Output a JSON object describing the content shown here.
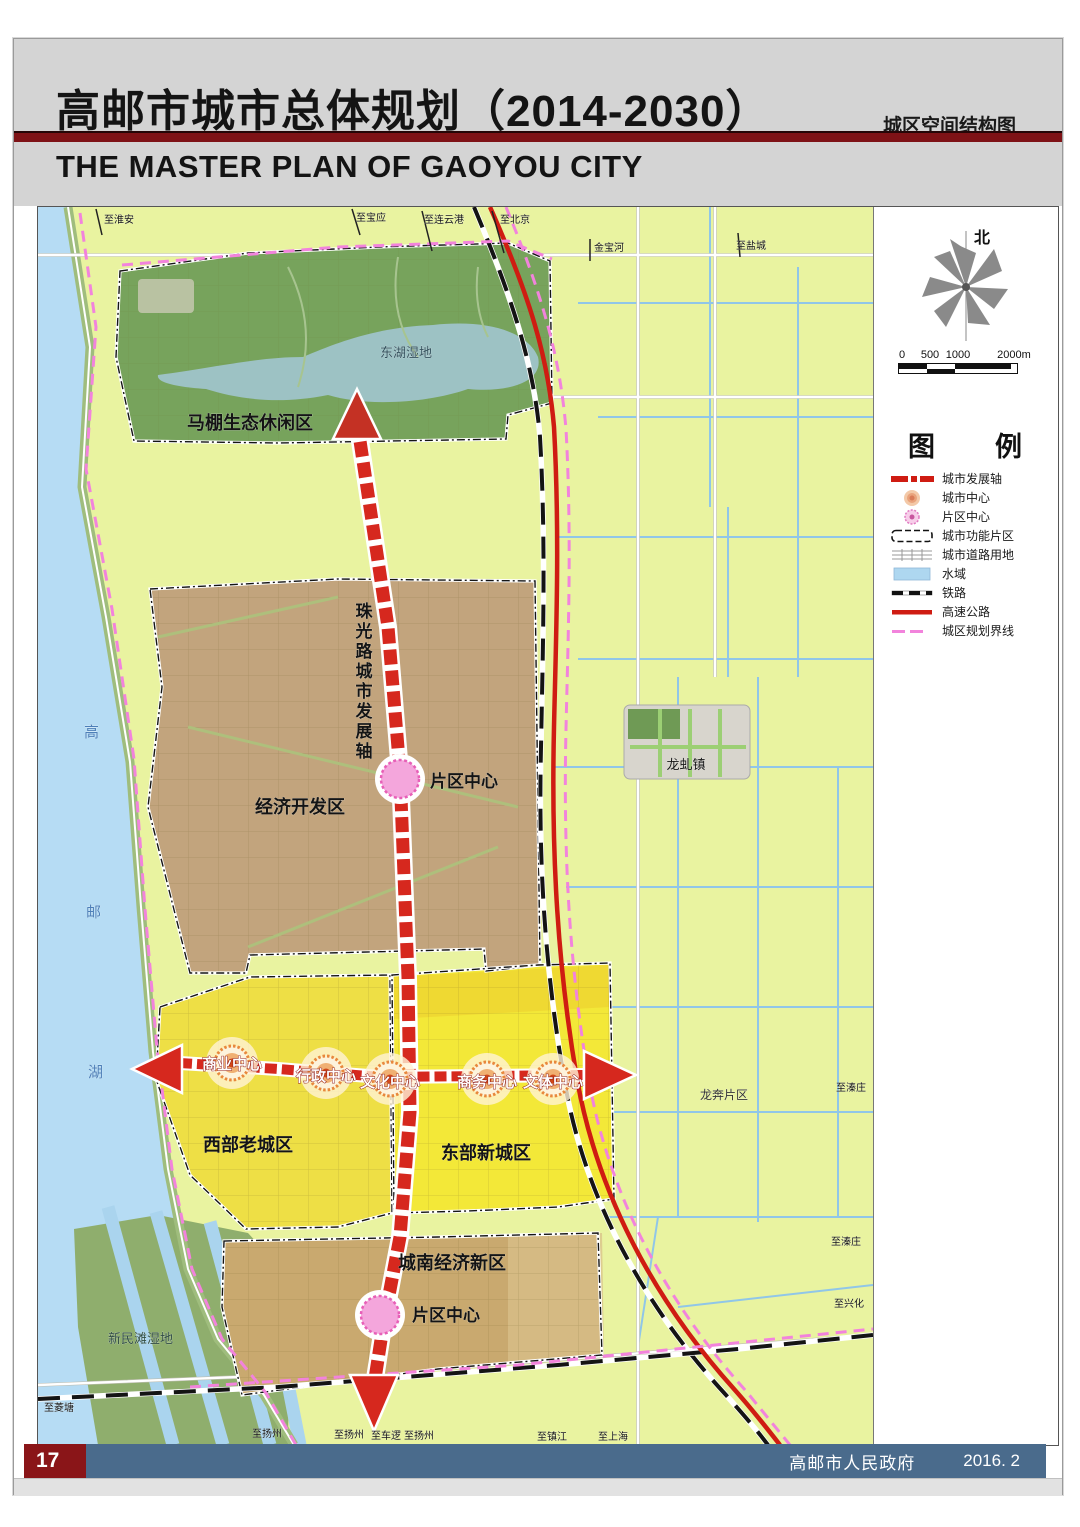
{
  "header": {
    "title_cn": "高邮市城市总体规划（2014-2030）",
    "map_name": "城区空间结构图",
    "title_en": "THE MASTER PLAN OF GAOYOU CITY"
  },
  "footer": {
    "page_number": "17",
    "publisher": "高邮市人民政府",
    "date": "2016. 2"
  },
  "compass": {
    "north_label": "北"
  },
  "scale_bar": {
    "ticks": [
      "0",
      "500",
      "1000",
      "2000m"
    ]
  },
  "legend": {
    "title": "图　　例",
    "items": [
      {
        "key": "axis",
        "label": "城市发展轴"
      },
      {
        "key": "city-center",
        "label": "城市中心"
      },
      {
        "key": "district-center",
        "label": "片区中心"
      },
      {
        "key": "functional-area",
        "label": "城市功能片区"
      },
      {
        "key": "road-land",
        "label": "城市道路用地"
      },
      {
        "key": "water",
        "label": "水域"
      },
      {
        "key": "railway",
        "label": "铁路"
      },
      {
        "key": "highway",
        "label": "高速公路"
      },
      {
        "key": "boundary",
        "label": "城区规划界线"
      }
    ]
  },
  "colors": {
    "accent_red": "#7e1216",
    "axis_red": "#cf1c12",
    "footer_blue": "#4a6b8c",
    "page_number_red": "#8a1518",
    "water_blue": "#b6dcf4",
    "boundary_pink": "#f283dc",
    "eco_green": "#77a35c",
    "econ_brown": "#c2a47d",
    "old_city_yellow": "#eedf45",
    "new_city_yellow": "#f3e838",
    "south_zone_tan": "#c9a96f"
  },
  "map": {
    "labels": [
      {
        "t": "至淮安",
        "x": 66,
        "y": 16,
        "s": 10
      },
      {
        "t": "至宝应",
        "x": 318,
        "y": 14,
        "s": 10
      },
      {
        "t": "至连云港",
        "x": 386,
        "y": 16,
        "s": 10
      },
      {
        "t": "至北京",
        "x": 462,
        "y": 16,
        "s": 10
      },
      {
        "t": "金宝河",
        "x": 556,
        "y": 44,
        "s": 10
      },
      {
        "t": "至盐城",
        "x": 698,
        "y": 42,
        "s": 10
      },
      {
        "t": "东湖湿地",
        "x": 368,
        "y": 150,
        "s": 13,
        "c": "#32505c",
        "a": "m"
      },
      {
        "t": "马棚生态休闲区",
        "x": 212,
        "y": 222,
        "s": 18,
        "w": "b",
        "a": "m"
      },
      {
        "t": "珠光路城市发展轴",
        "x": 326,
        "y": 410,
        "s": 17,
        "w": "b",
        "v": true,
        "a": "m"
      },
      {
        "t": "片区中心",
        "x": 392,
        "y": 580,
        "s": 17,
        "w": "b"
      },
      {
        "t": "经济开发区",
        "x": 262,
        "y": 606,
        "s": 18,
        "w": "b",
        "a": "m"
      },
      {
        "t": "高",
        "x": 46,
        "y": 530,
        "s": 15,
        "c": "#4d7fb8"
      },
      {
        "t": "邮",
        "x": 48,
        "y": 710,
        "s": 15,
        "c": "#4d7fb8"
      },
      {
        "t": "湖",
        "x": 50,
        "y": 870,
        "s": 15,
        "c": "#4d7fb8"
      },
      {
        "t": "龙虬镇",
        "x": 648,
        "y": 562,
        "s": 13,
        "a": "m"
      },
      {
        "t": "商业中心",
        "x": 194,
        "y": 862,
        "s": 15,
        "st": "axis",
        "a": "m"
      },
      {
        "t": "行政中心",
        "x": 288,
        "y": 874,
        "s": 15,
        "st": "axis",
        "a": "m"
      },
      {
        "t": "文化中心",
        "x": 352,
        "y": 880,
        "s": 15,
        "st": "axis",
        "a": "m"
      },
      {
        "t": "商务中心",
        "x": 449,
        "y": 880,
        "s": 15,
        "st": "axis",
        "a": "m"
      },
      {
        "t": "文体中心",
        "x": 515,
        "y": 880,
        "s": 15,
        "st": "axis",
        "a": "m"
      },
      {
        "t": "龙奔片区",
        "x": 662,
        "y": 892,
        "s": 12,
        "c": "#333333"
      },
      {
        "t": "至溱庄",
        "x": 798,
        "y": 884,
        "s": 10
      },
      {
        "t": "西部老城区",
        "x": 210,
        "y": 944,
        "s": 18,
        "w": "b",
        "a": "m"
      },
      {
        "t": "东部新城区",
        "x": 448,
        "y": 952,
        "s": 18,
        "w": "b",
        "a": "m"
      },
      {
        "t": "至溱庄",
        "x": 793,
        "y": 1038,
        "s": 10
      },
      {
        "t": "城南经济新区",
        "x": 414,
        "y": 1062,
        "s": 18,
        "w": "b",
        "a": "m"
      },
      {
        "t": "至兴化",
        "x": 796,
        "y": 1100,
        "s": 10
      },
      {
        "t": "片区中心",
        "x": 374,
        "y": 1114,
        "s": 17,
        "w": "b"
      },
      {
        "t": "新民滩湿地",
        "x": 70,
        "y": 1136,
        "s": 13,
        "c": "#2f4c42"
      },
      {
        "t": "至菱塘",
        "x": 6,
        "y": 1204,
        "s": 10
      },
      {
        "t": "至扬州",
        "x": 214,
        "y": 1230,
        "s": 10
      },
      {
        "t": "至扬州",
        "x": 296,
        "y": 1231,
        "s": 10
      },
      {
        "t": "至车逻",
        "x": 333,
        "y": 1232,
        "s": 10
      },
      {
        "t": "至扬州",
        "x": 366,
        "y": 1232,
        "s": 10
      },
      {
        "t": "至镇江",
        "x": 499,
        "y": 1233,
        "s": 10
      },
      {
        "t": "至上海",
        "x": 560,
        "y": 1233,
        "s": 10
      }
    ]
  }
}
